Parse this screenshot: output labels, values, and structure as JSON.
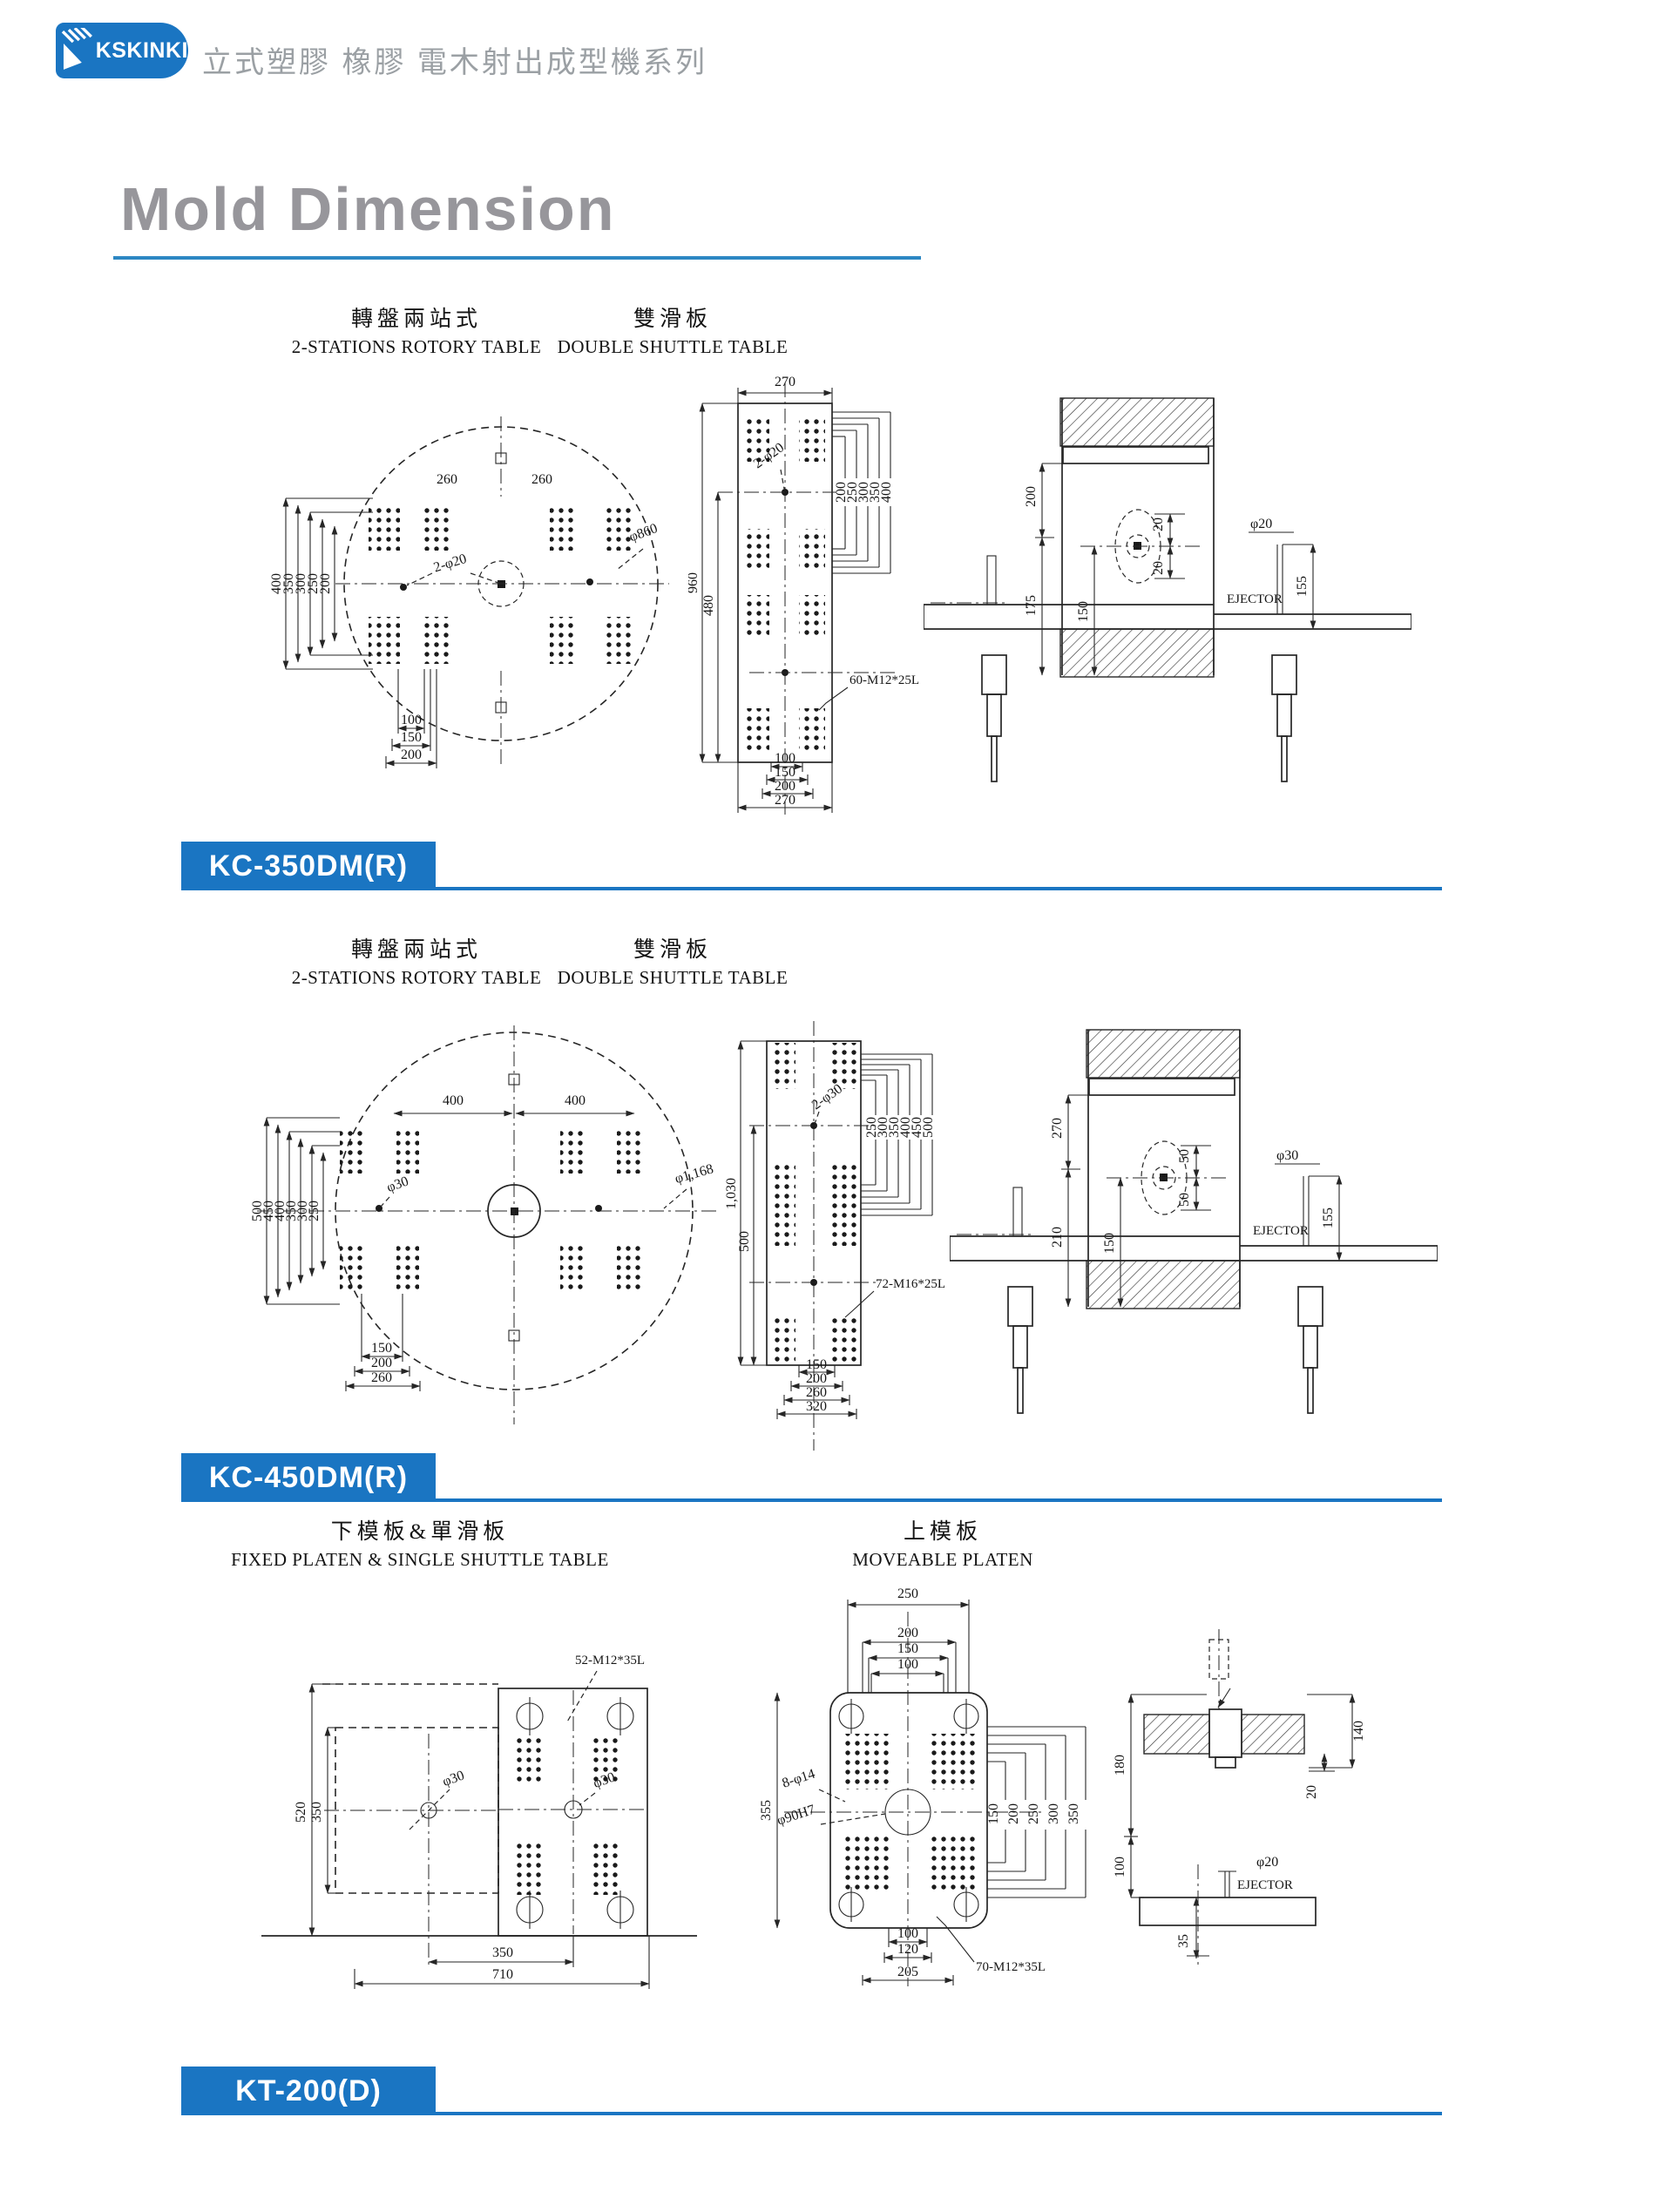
{
  "header": {
    "logo": "KSKINKI",
    "tagline": "立式塑膠 橡膠 電木射出成型機系列"
  },
  "title": "Mold Dimension",
  "sections": [
    {
      "badge": "KC-350DM(R)",
      "columns": [
        {
          "zh": "轉盤兩站式",
          "en": "2-STATIONS ROTORY TABLE"
        },
        {
          "zh": "雙滑板",
          "en": "DOUBLE SHUTTLE TABLE"
        }
      ],
      "rotary": {
        "top_dim_left": "260",
        "top_dim_right": "260",
        "left_dims": [
          "400",
          "350",
          "300",
          "250",
          "200"
        ],
        "hole_note": "2-φ20",
        "diameter_note": "φ860",
        "bottom_dims": [
          "100",
          "150",
          "200"
        ]
      },
      "shuttle": {
        "top_dim": "270",
        "left_outer": "960",
        "left_inner": "480",
        "right_dims": [
          "200",
          "250",
          "300",
          "350",
          "400"
        ],
        "hole_note": "2-φ20",
        "bolt_note": "60-M12*25L",
        "bottom_dims": [
          "100",
          "150",
          "200",
          "270"
        ]
      },
      "section_view": {
        "upper_dim": "200",
        "mid_dim": "175",
        "inner_dim": "150",
        "offset_a": "20",
        "offset_b": "20",
        "ejector_dia": "φ20",
        "stroke_dim": "155",
        "ejector_label": "EJECTOR"
      }
    },
    {
      "badge": "KC-450DM(R)",
      "columns": [
        {
          "zh": "轉盤兩站式",
          "en": "2-STATIONS ROTORY TABLE"
        },
        {
          "zh": "雙滑板",
          "en": "DOUBLE SHUTTLE TABLE"
        }
      ],
      "rotary": {
        "top_dim_left": "400",
        "top_dim_right": "400",
        "left_dims": [
          "500",
          "450",
          "400",
          "350",
          "300",
          "250"
        ],
        "hole_note": "φ30",
        "diameter_note": "φ1,168",
        "bottom_dims": [
          "150",
          "200",
          "260"
        ]
      },
      "shuttle": {
        "left_outer": "1,030",
        "left_inner": "500",
        "right_dims": [
          "250",
          "300",
          "350",
          "400",
          "450",
          "500"
        ],
        "hole_note": "2-φ30",
        "bolt_note": "72-M16*25L",
        "bottom_dims": [
          "150",
          "200",
          "260",
          "320"
        ]
      },
      "section_view": {
        "upper_dim": "270",
        "mid_dim": "210",
        "inner_dim": "150",
        "offset_a": "50",
        "offset_b": "50",
        "ejector_dia": "φ30",
        "stroke_dim": "155",
        "ejector_label": "EJECTOR"
      }
    },
    {
      "badge": "KT-200(D)",
      "columns": [
        {
          "zh": "下模板&單滑板",
          "en": "FIXED PLATEN & SINGLE SHUTTLE TABLE"
        },
        {
          "zh": "上模板",
          "en": "MOVEABLE PLATEN"
        }
      ],
      "fixed_platen": {
        "bolt_note": "52-M12*35L",
        "outer_dim": "520",
        "inner_dim": "350",
        "hole_note_left": "φ30",
        "hole_note_right": "φ30",
        "bottom_inner": "350",
        "bottom_outer": "710"
      },
      "moveable_platen": {
        "top_dims": [
          "250",
          "200",
          "150",
          "100"
        ],
        "side_dim": "355",
        "holes_note": "8-φ14",
        "center_bore": "φ90H7",
        "right_dims": [
          "150",
          "200",
          "250",
          "300",
          "350"
        ],
        "bottom_dims": [
          "100",
          "120",
          "205"
        ],
        "bolt_note": "70-M12*35L"
      },
      "section_view": {
        "plate_dim": "140",
        "gap_dim": "20",
        "upper_dim": "180",
        "lower_dim": "100",
        "base_dim": "35",
        "ejector_dia": "φ20",
        "ejector_label": "EJECTOR"
      }
    }
  ],
  "colors": {
    "brand_blue": "#1a75c2",
    "rule_blue": "#2d87c3",
    "title_gray": "#97969b",
    "ink": "#262626"
  }
}
